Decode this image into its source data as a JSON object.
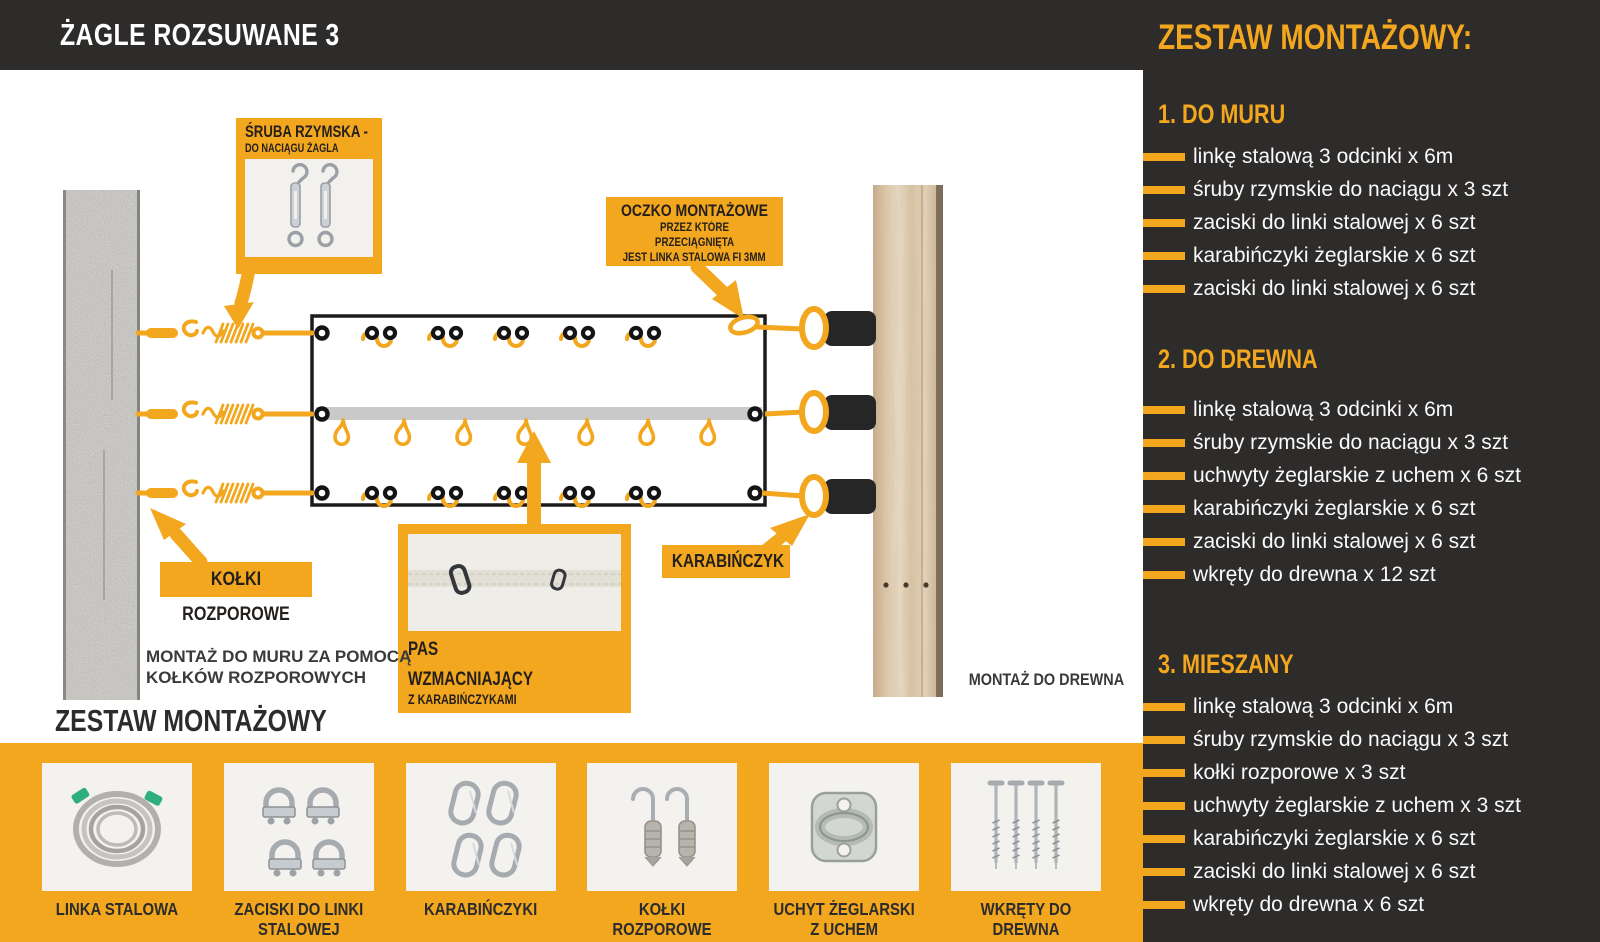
{
  "title": "ŻAGLE ROZSUWANE 3",
  "panel": {
    "heading": "ZESTAW MONTAŻOWY:",
    "sections": [
      {
        "heading": "1. DO MURU",
        "items": [
          "linkę stalową 3 odcinki x 6m",
          "śruby rzymskie do naciągu x 3 szt",
          "zaciski do linki stalowej x 6 szt",
          "karabińczyki żeglarskie x 6 szt",
          "zaciski do linki stalowej x 6 szt"
        ]
      },
      {
        "heading": "2. DO DREWNA",
        "items": [
          "linkę stalową 3 odcinki x 6m",
          "śruby rzymskie do naciągu x 3 szt",
          "uchwyty żeglarskie z uchem x 6 szt",
          "karabińczyki żeglarskie x 6 szt",
          "zaciski do linki stalowej x 6 szt",
          "wkręty do drewna x 12 szt"
        ]
      },
      {
        "heading": "3. MIESZANY",
        "items": [
          "linkę stalową 3 odcinki x 6m",
          "śruby rzymskie do naciągu x 3 szt",
          "kołki rozporowe x 3 szt",
          "uchwyty żeglarskie z uchem x 3 szt",
          "karabińczyki żeglarskie x 6 szt",
          "zaciski do linki stalowej x 6 szt",
          "wkręty do drewna x 6 szt"
        ]
      }
    ]
  },
  "diagram": {
    "callouts": {
      "sruba": {
        "title": "ŚRUBA RZYMSKA -",
        "subtitle": "DO NACIĄGU ŻAGLA"
      },
      "oczko": {
        "title": "OCZKO MONTAŻOWE",
        "line2": "PRZEZ KTÓRE PRZECIĄGNIĘTA",
        "line3": "JEST LINKA STALOWA FI 3MM"
      },
      "kolki": {
        "title": "KOŁKI ROZPOROWE"
      },
      "pas": {
        "line1": "PAS",
        "line2": "WZMACNIAJĄCY",
        "line3": "Z KARABIŃCZYKAMI"
      },
      "karabinczyk": {
        "title": "KARABIŃCZYK"
      }
    },
    "captions": {
      "mur": "MONTAŻ DO MURU ZA POMOCĄ\nKOŁKÓW ROZPOROWYCH",
      "drewno": "MONTAŻ DO DREWNA"
    }
  },
  "bottom": {
    "heading": "ZESTAW MONTAŻOWY",
    "products": [
      {
        "label": "LINKA STALOWA"
      },
      {
        "label": "ZACISKI DO LINKI\nSTALOWEJ"
      },
      {
        "label": "KARABIŃCZYKI"
      },
      {
        "label": "KOŁKI ROZPOROWE"
      },
      {
        "label": "UCHYT ŻEGLARSKI\nZ UCHEM"
      },
      {
        "label": "WKRĘTY DO DREWNA"
      }
    ]
  },
  "colors": {
    "accent": "#F2A71E",
    "dark": "#2E2C2B"
  }
}
